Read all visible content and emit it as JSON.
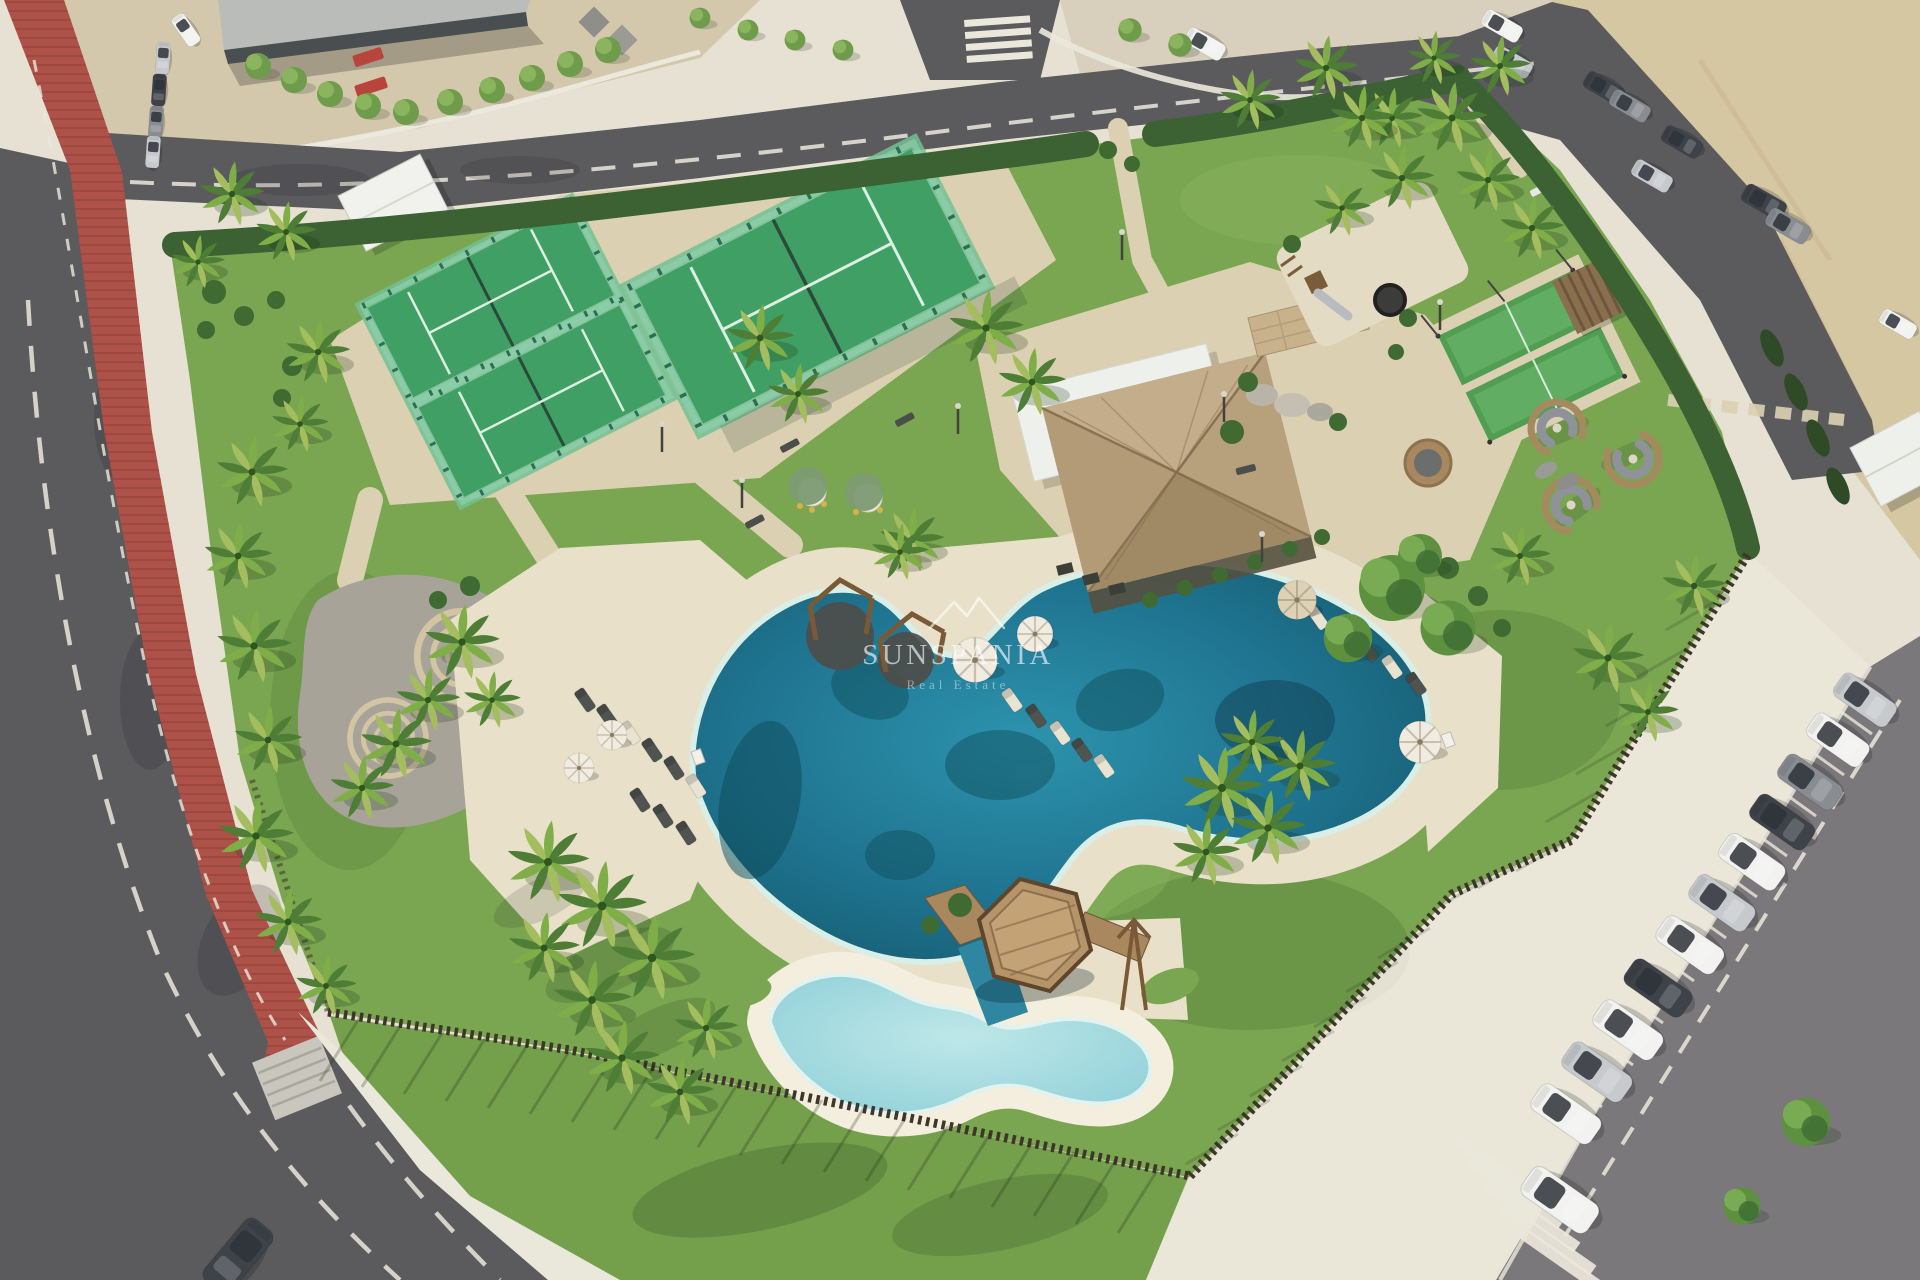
{
  "watermark": {
    "brand": "SUNSPANIA",
    "tagline": "Real Estate",
    "logo_icon": "mountain-peaks-icon",
    "color": "#ffffff"
  },
  "palette": {
    "lawn": "#7aa551",
    "lawnLight": "#8ab45e",
    "lawnShadow": "#43702f",
    "lawnOut": "#74a04c",
    "hedge": "#3c6132",
    "canopy": "#5d9140",
    "canopyLight": "#79ab55",
    "canopyDark": "#3f6b33",
    "palmA": "#4e7d35",
    "palmB": "#7fae48",
    "palmC": "#a4bd5e",
    "road": "#5b5b5e",
    "roadLight": "#7b787b",
    "curb": "#ebe8dc",
    "plaza": "#d3c7ac",
    "plazaLight": "#d8cfbc",
    "bike": "#ae5249",
    "bikeStripe": "#8c3f38",
    "walk": "#eae7db",
    "path": "#dbd0b2",
    "promenade": "#e6e1d2",
    "deck": "#e8e0c8",
    "deckWhite": "#f3eedd",
    "gravel": "#a7a399",
    "stoneRing": "#d3c5a3",
    "sand": "#d6c7a3",
    "waterDeep": "#15586d",
    "waterMid": "#1f7490",
    "waterLight": "#7fc9d4",
    "waterPale": "#a9dde1",
    "court": "#3f9f64",
    "courtLight": "#74c191",
    "glass": "#8fd2b4",
    "glassPost": "#2e6e53",
    "turf": "#519e53",
    "turfLight": "#6ab36c",
    "roofWhite": "#eef0ec",
    "roofA": "#c3ad8a",
    "roofB": "#b29b76",
    "roofC": "#a08a66",
    "roofD": "#b7a17d",
    "ridge": "#8a7354",
    "stone": "#c8b28c",
    "boulder": "#b9b4a7",
    "terrace": "#55503f",
    "wood": "#a9875f",
    "woodDark": "#6f5436",
    "fence": "#3f352a",
    "cypress": "#2e4a27",
    "carWhite": "#f2f2f0",
    "carSilver": "#c7cacd",
    "carGray": "#898d91",
    "carDark": "#3e4349",
    "red": "#b8443c",
    "umbWhite": "#f1ece0",
    "umbTan": "#ddd2b6",
    "loungerDark": "#4f5451",
    "loungerLight": "#e9e3d2",
    "watermark": "#ffffff"
  }
}
